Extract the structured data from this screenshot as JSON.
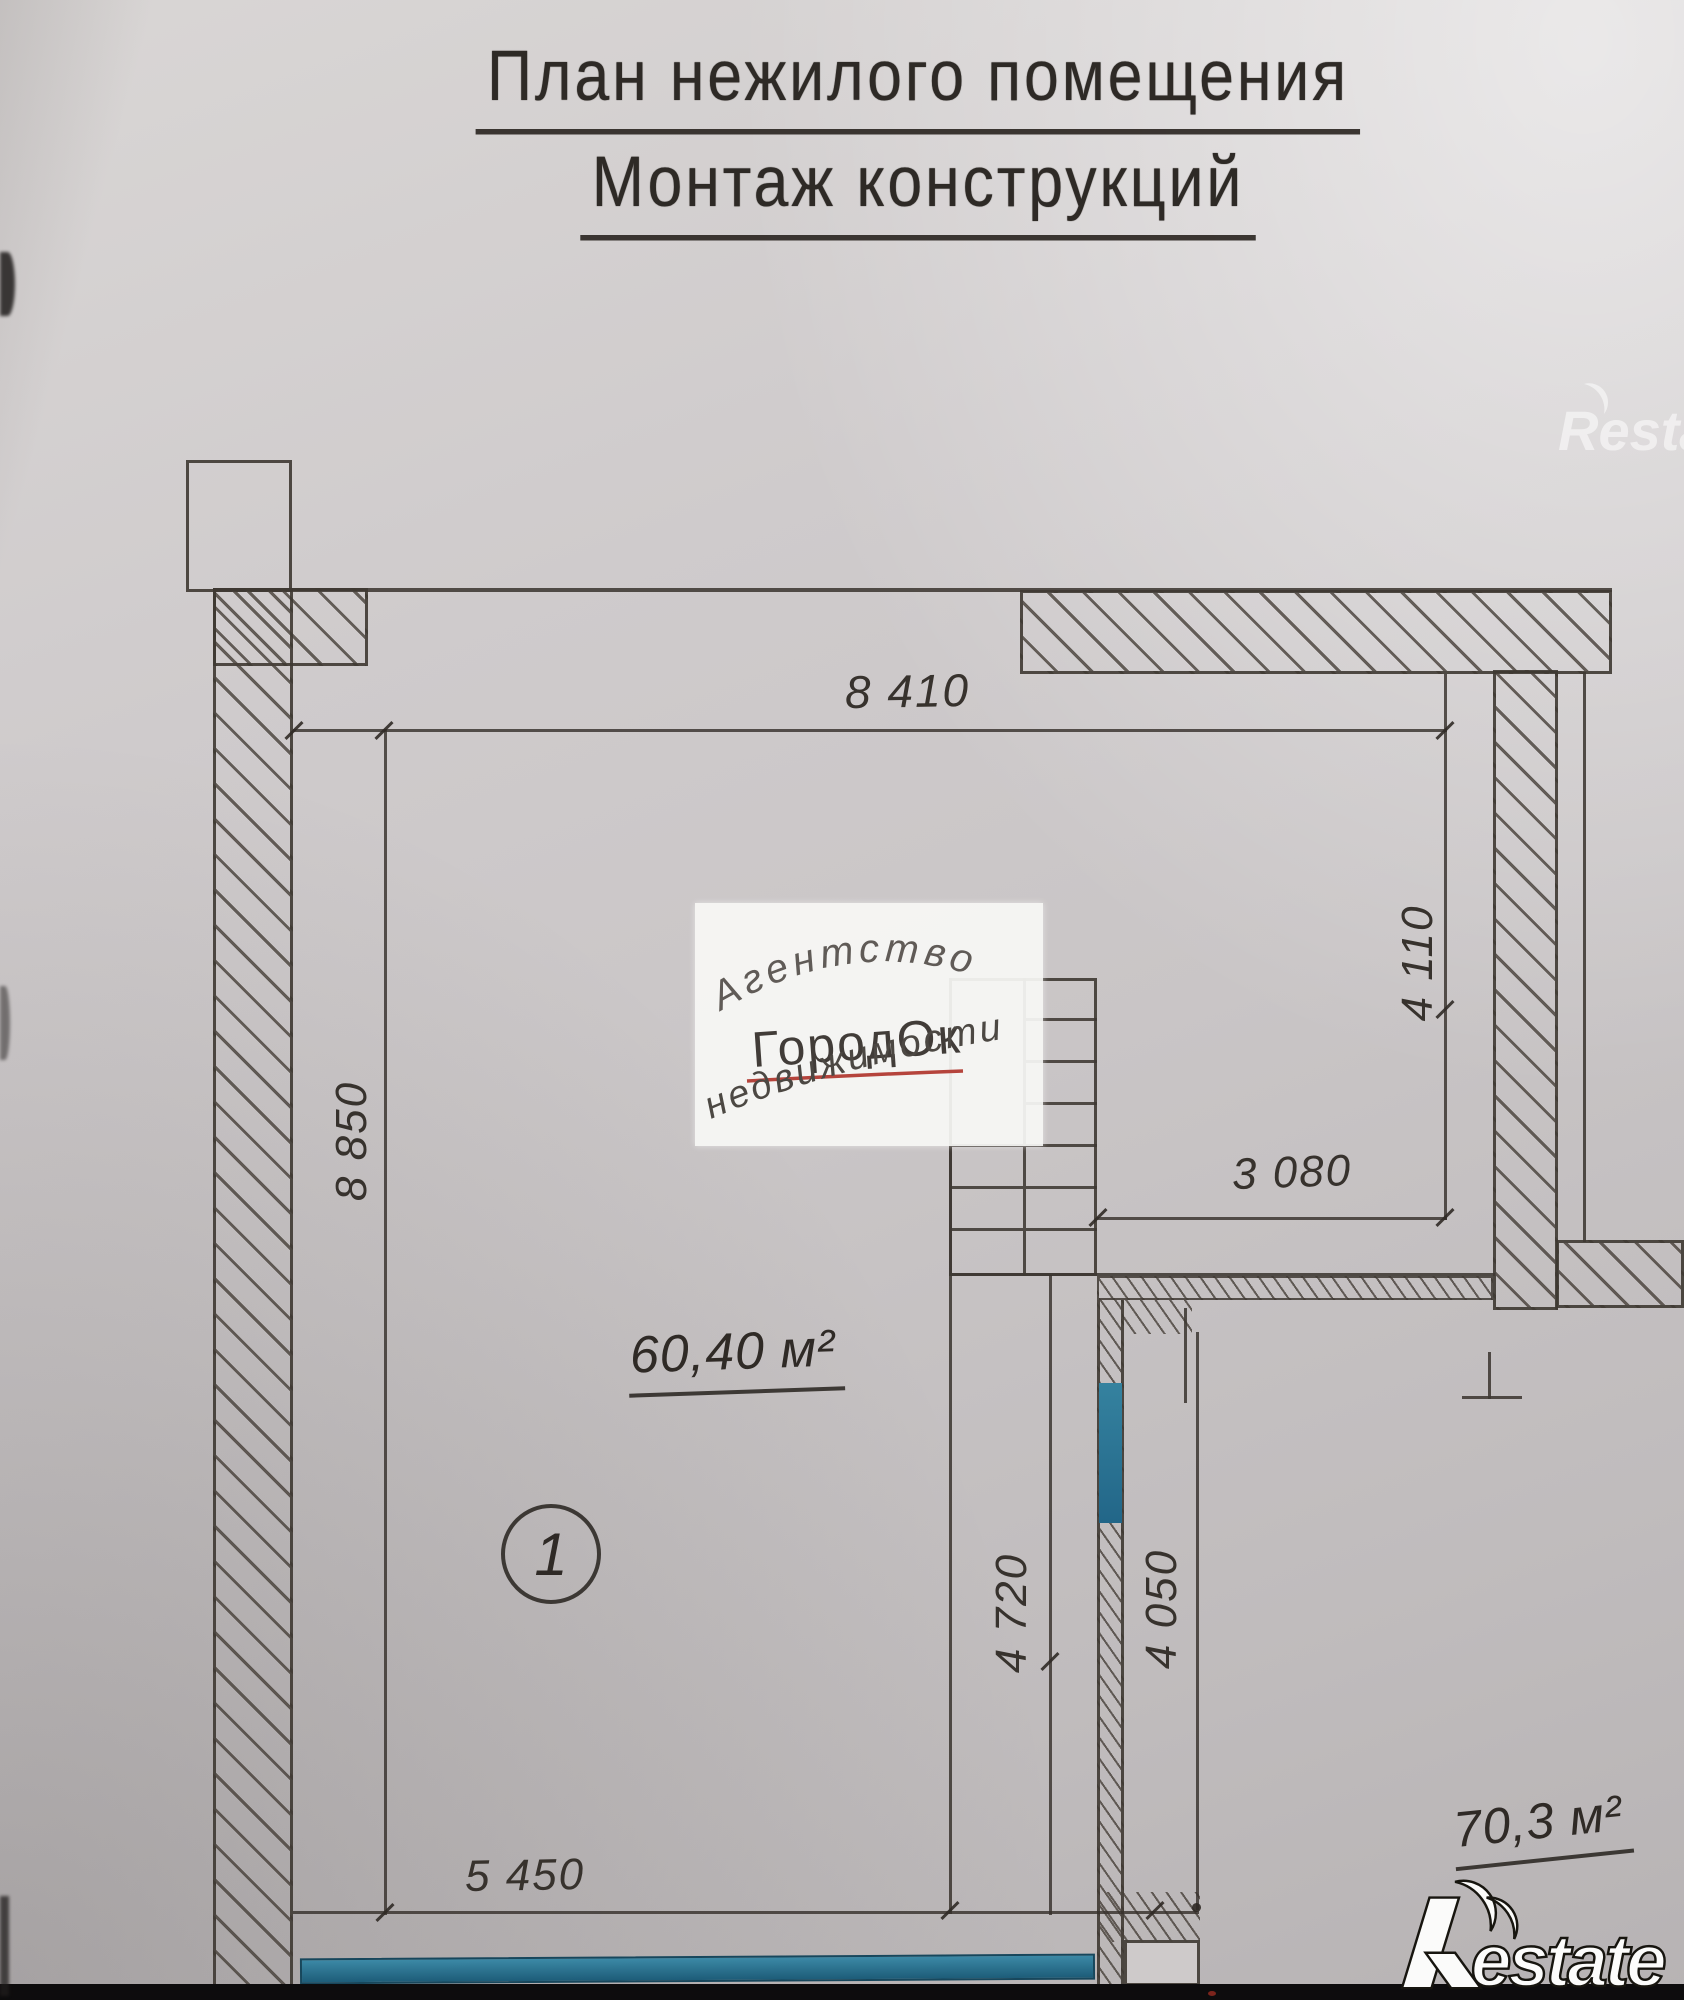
{
  "title": {
    "line1": "План нежилого помещения",
    "line2": "Монтаж конструкций"
  },
  "dimensions": {
    "top": "8 410",
    "left": "8 850",
    "right_upper": "4 110",
    "inner_horizontal": "3 080",
    "stair_left": "4 720",
    "stair_right": "4 050",
    "bottom": "5 450"
  },
  "rooms": [
    {
      "number": "1",
      "area_label": "60,40 м²"
    },
    {
      "area_label": "70,3 м²"
    }
  ],
  "watermark": {
    "line1": "Агентство",
    "line2": "ГородОк",
    "line3": "недвижимости"
  },
  "logo": {
    "brand": "Restate",
    "estate_part": "estate"
  },
  "colors": {
    "accent_teal": "#2a7794",
    "underline_red": "#b5443c",
    "drawing_line": "#3e3935",
    "paper": "#c9c5c6"
  }
}
